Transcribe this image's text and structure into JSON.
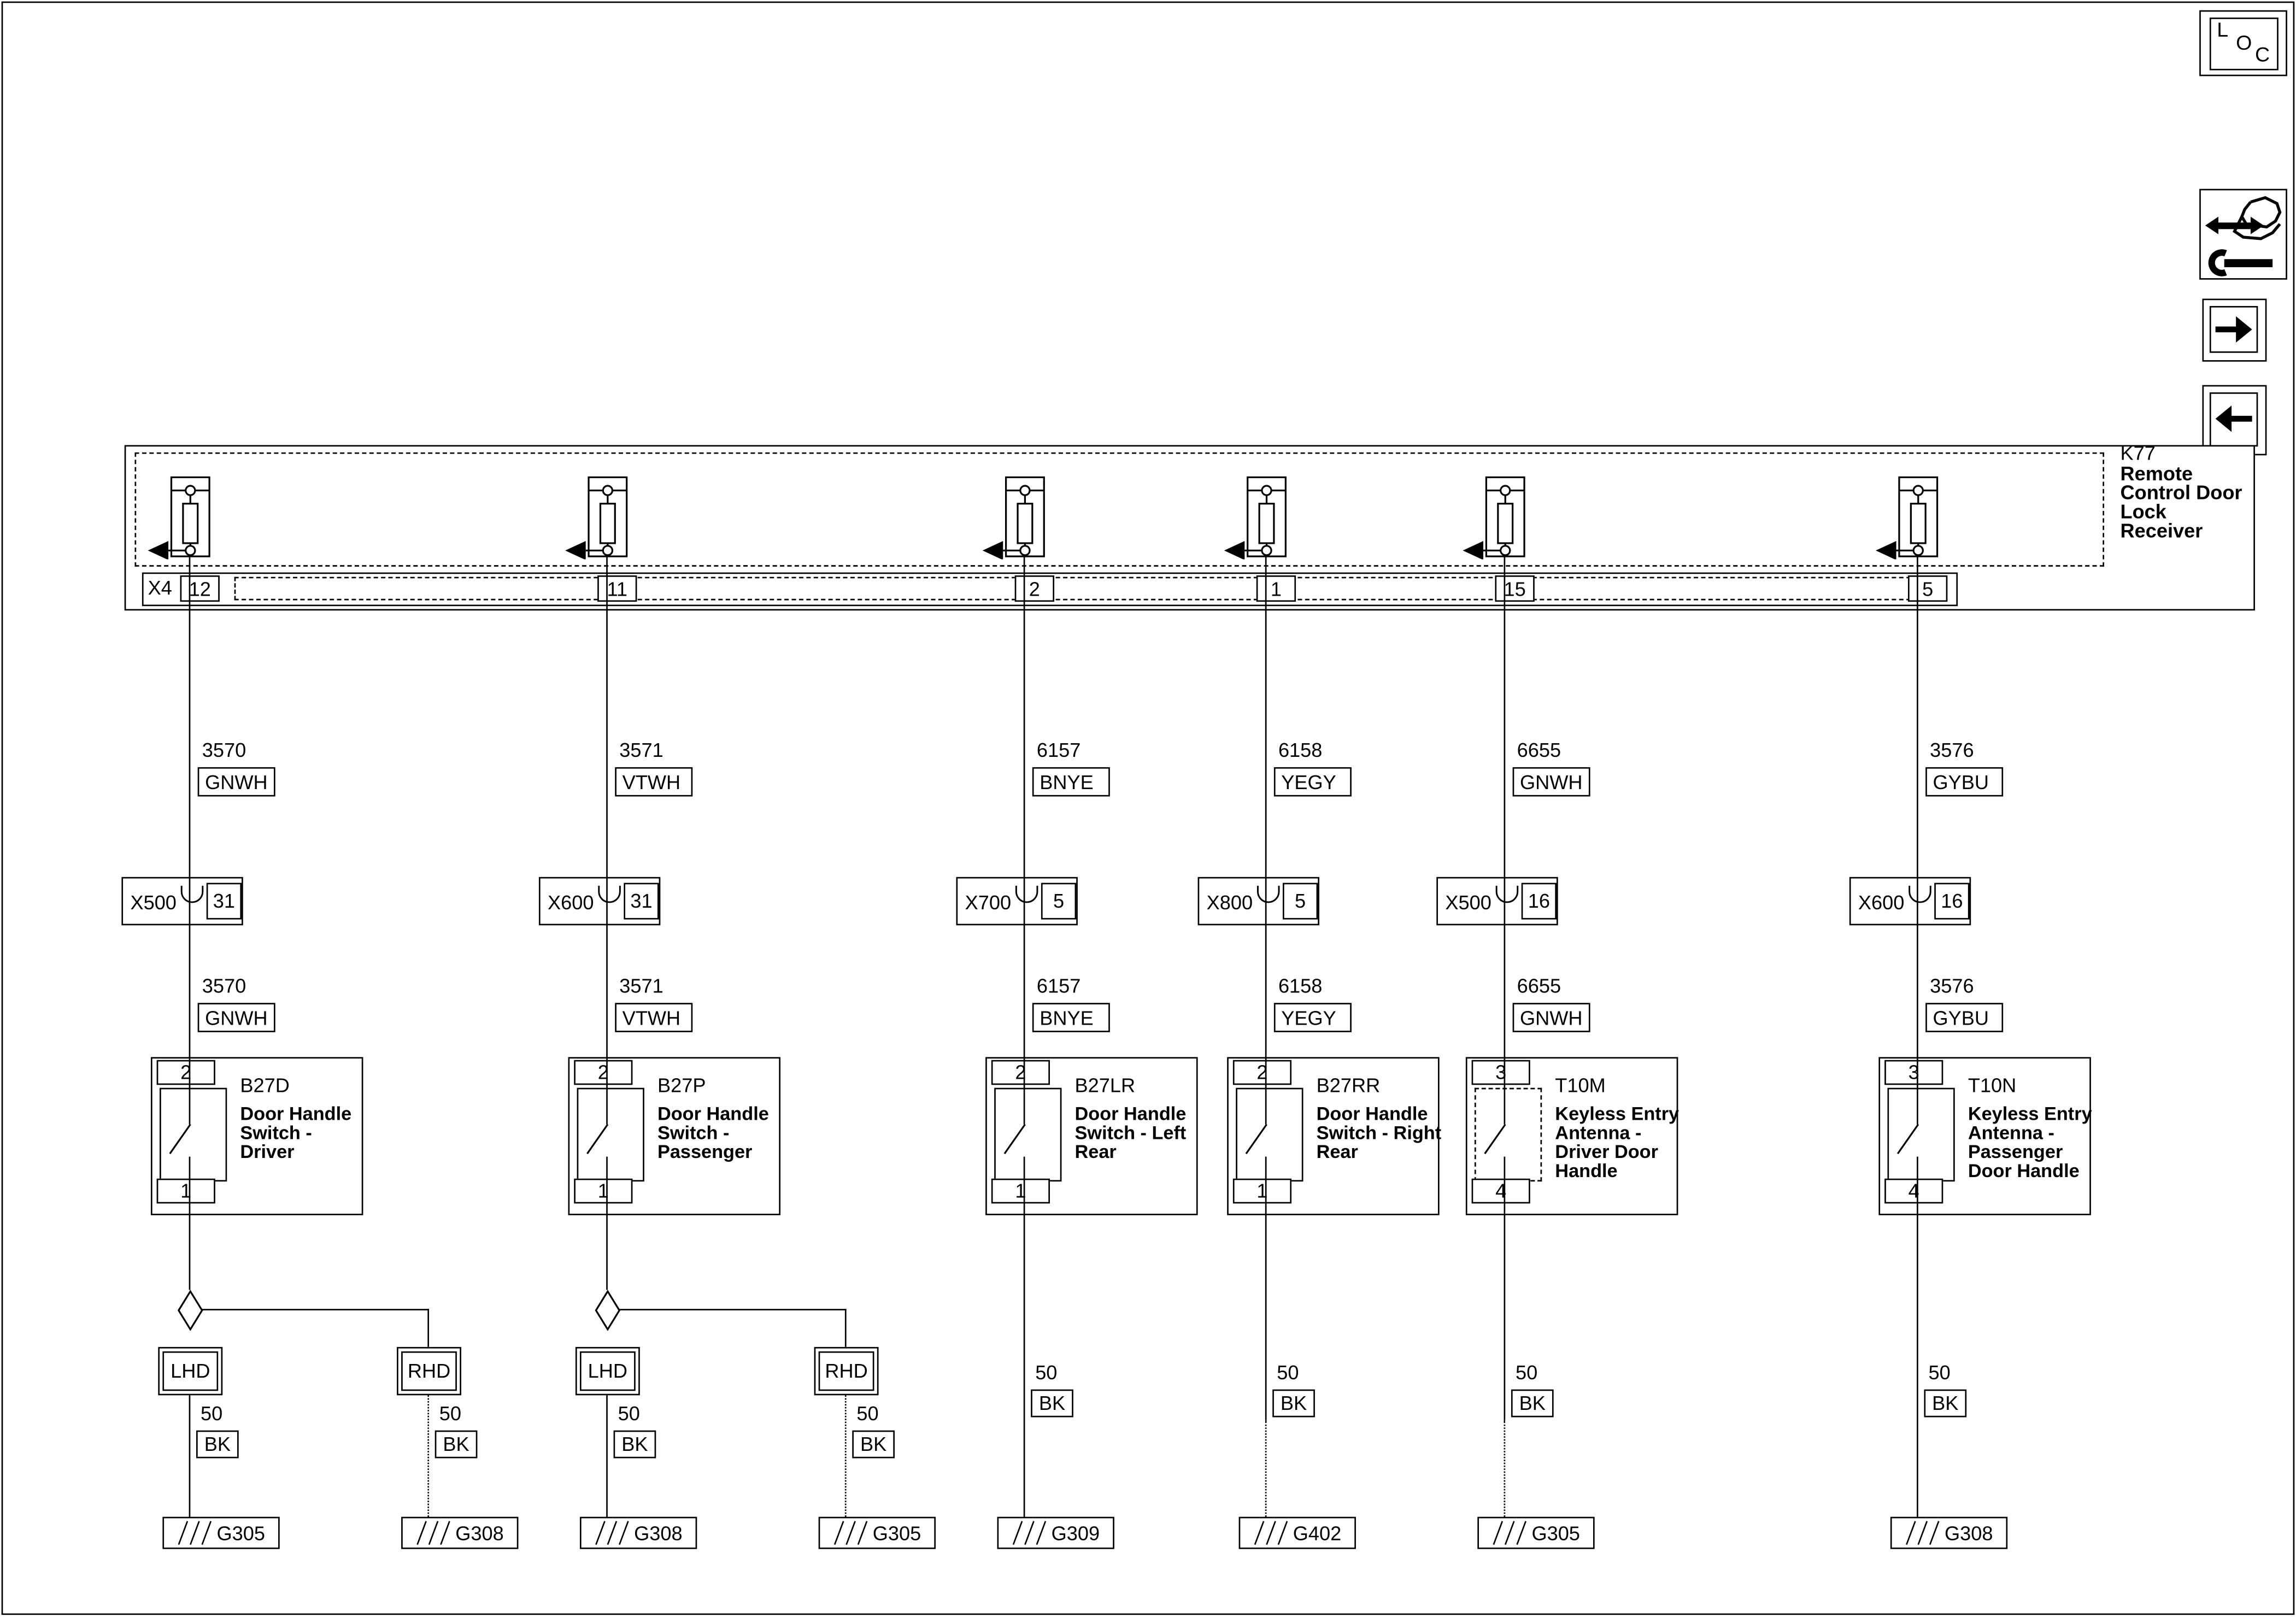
{
  "toolbar": {
    "loc": {
      "l": "L",
      "o": "O",
      "c": "C"
    }
  },
  "receiver": {
    "id": "K77",
    "name_lines": [
      "Remote",
      "Control Door",
      "Lock",
      "Receiver"
    ],
    "connector": "X4",
    "pins": [
      "12",
      "11",
      "2",
      "1",
      "15",
      "5"
    ]
  },
  "columns": [
    {
      "wire": {
        "circuit": "3570",
        "color": "GNWH"
      },
      "connector": {
        "name": "X500",
        "pin": "31"
      },
      "component": {
        "id": "B27D",
        "top_pin": "2",
        "bottom_pin": "1",
        "name_lines": [
          "Door Handle",
          "Switch -",
          "Driver"
        ]
      },
      "branches": {
        "lhd": {
          "label": "LHD",
          "circuit": "50",
          "color": "BK",
          "ground": "G305"
        },
        "rhd": {
          "label": "RHD",
          "circuit": "50",
          "color": "BK",
          "ground": "G308"
        }
      }
    },
    {
      "wire": {
        "circuit": "3571",
        "color": "VTWH"
      },
      "connector": {
        "name": "X600",
        "pin": "31"
      },
      "component": {
        "id": "B27P",
        "top_pin": "2",
        "bottom_pin": "1",
        "name_lines": [
          "Door Handle",
          "Switch -",
          "Passenger"
        ]
      },
      "branches": {
        "lhd": {
          "label": "LHD",
          "circuit": "50",
          "color": "BK",
          "ground": "G308"
        },
        "rhd": {
          "label": "RHD",
          "circuit": "50",
          "color": "BK",
          "ground": "G305"
        }
      }
    },
    {
      "wire": {
        "circuit": "6157",
        "color": "BNYE"
      },
      "connector": {
        "name": "X700",
        "pin": "5"
      },
      "component": {
        "id": "B27LR",
        "top_pin": "2",
        "bottom_pin": "1",
        "name_lines": [
          "Door Handle",
          "Switch - Left",
          "Rear"
        ]
      },
      "ground_wire": {
        "circuit": "50",
        "color": "BK",
        "ground": "G309"
      }
    },
    {
      "wire": {
        "circuit": "6158",
        "color": "YEGY"
      },
      "connector": {
        "name": "X800",
        "pin": "5"
      },
      "component": {
        "id": "B27RR",
        "top_pin": "2",
        "bottom_pin": "1",
        "name_lines": [
          "Door Handle",
          "Switch - Right",
          "Rear"
        ]
      },
      "ground_wire": {
        "circuit": "50",
        "color": "BK",
        "ground": "G402"
      }
    },
    {
      "wire": {
        "circuit": "6655",
        "color": "GNWH"
      },
      "connector": {
        "name": "X500",
        "pin": "16"
      },
      "component": {
        "id": "T10M",
        "top_pin": "3",
        "bottom_pin": "4",
        "name_lines": [
          "Keyless Entry",
          "Antenna -",
          "Driver Door",
          "Handle"
        ]
      },
      "ground_wire": {
        "circuit": "50",
        "color": "BK",
        "ground": "G305"
      }
    },
    {
      "wire": {
        "circuit": "3576",
        "color": "GYBU"
      },
      "connector": {
        "name": "X600",
        "pin": "16"
      },
      "component": {
        "id": "T10N",
        "top_pin": "3",
        "bottom_pin": "4",
        "name_lines": [
          "Keyless Entry",
          "Antenna -",
          "Passenger",
          "Door Handle"
        ]
      },
      "ground_wire": {
        "circuit": "50",
        "color": "BK",
        "ground": "G308"
      }
    }
  ]
}
